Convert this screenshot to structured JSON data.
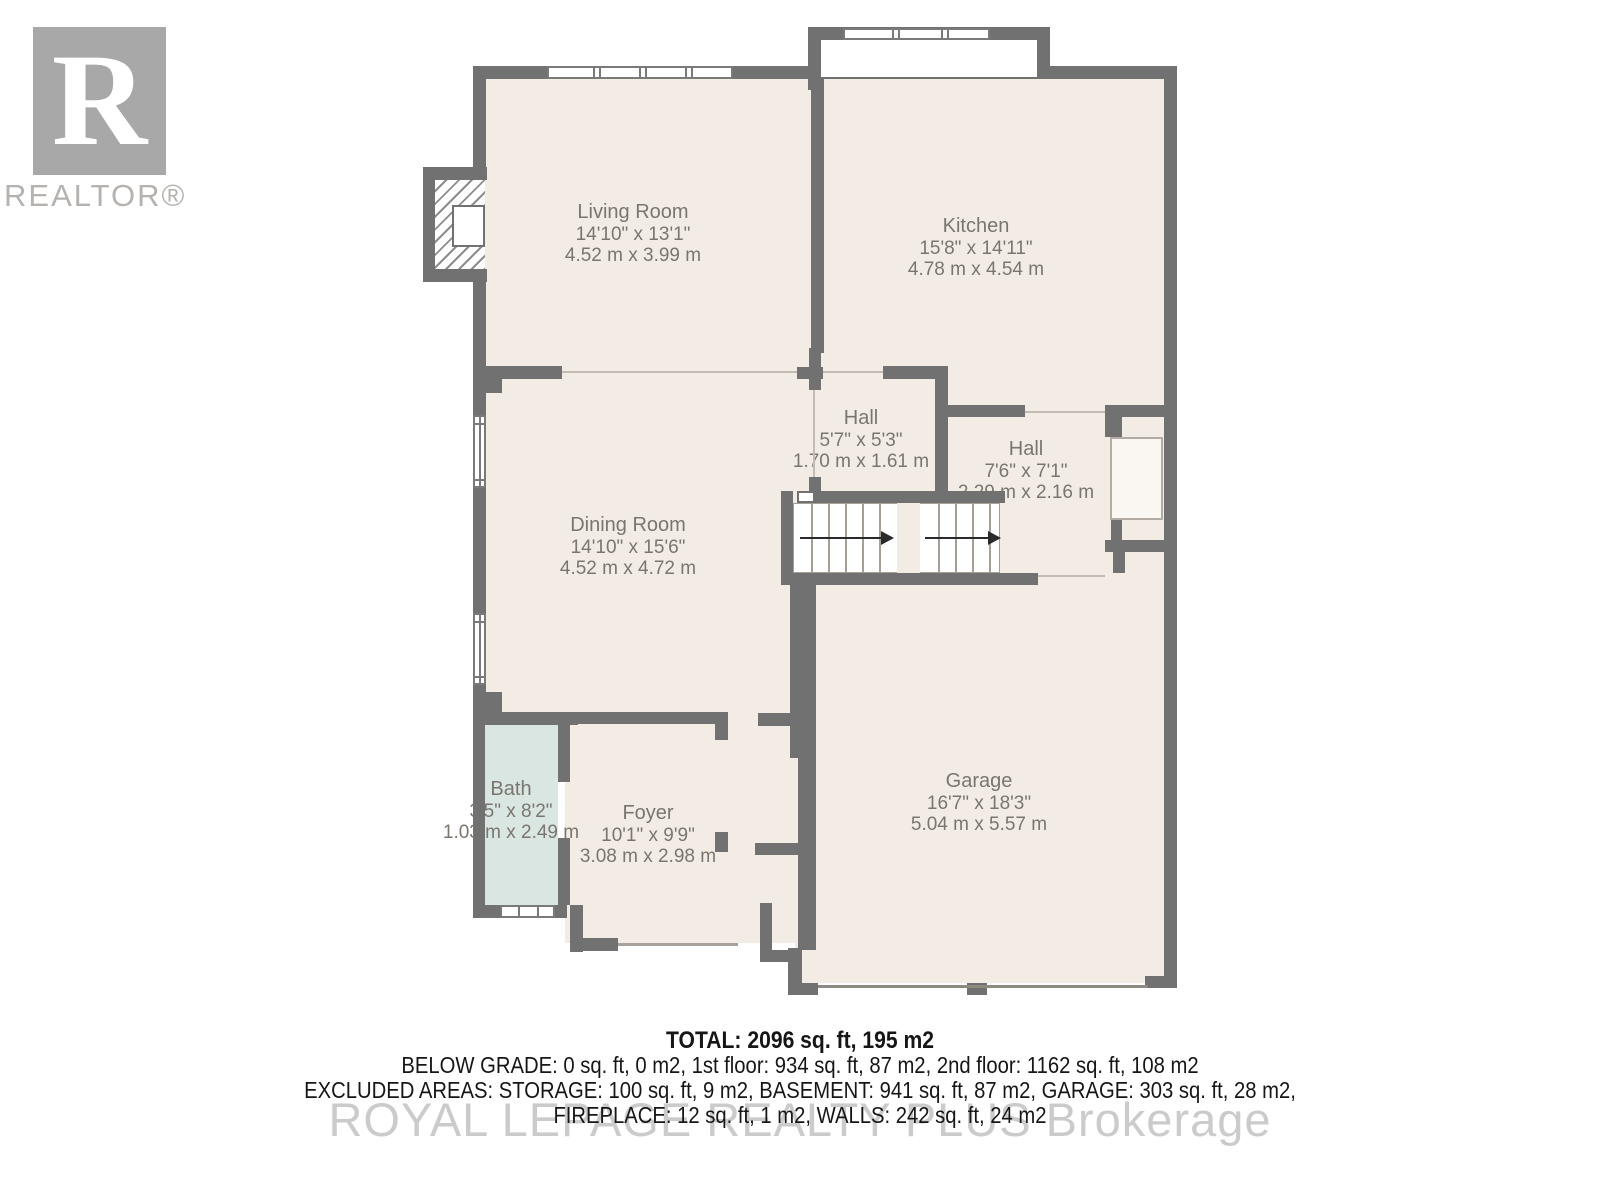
{
  "logo": {
    "letter": "R",
    "label": "REALTOR®"
  },
  "rooms": [
    {
      "id": "living-room",
      "name": "Living Room",
      "imperial": "14'10\" x 13'1\"",
      "metric": "4.52 m x 3.99 m"
    },
    {
      "id": "kitchen",
      "name": "Kitchen",
      "imperial": "15'8\" x 14'11\"",
      "metric": "4.78 m x 4.54 m"
    },
    {
      "id": "hall-1",
      "name": "Hall",
      "imperial": "5'7\" x 5'3\"",
      "metric": "1.70 m x 1.61 m"
    },
    {
      "id": "hall-2",
      "name": "Hall",
      "imperial": "7'6\" x 7'1\"",
      "metric": "2.29 m x 2.16 m"
    },
    {
      "id": "dining-room",
      "name": "Dining Room",
      "imperial": "14'10\" x 15'6\"",
      "metric": "4.52 m x 4.72 m"
    },
    {
      "id": "bath",
      "name": "Bath",
      "imperial": "3'5\" x 8'2\"",
      "metric": "1.03 m x 2.49 m"
    },
    {
      "id": "foyer",
      "name": "Foyer",
      "imperial": "10'1\" x 9'9\"",
      "metric": "3.08 m x 2.98 m"
    },
    {
      "id": "garage",
      "name": "Garage",
      "imperial": "16'7\" x 18'3\"",
      "metric": "5.04 m x 5.57 m"
    }
  ],
  "summary": {
    "total": "TOTAL: 2096 sq. ft, 195 m2",
    "line2": "BELOW GRADE: 0 sq. ft, 0 m2, 1st floor: 934 sq. ft, 87 m2, 2nd floor: 1162 sq. ft, 108 m2",
    "line3": "EXCLUDED AREAS: STORAGE: 100 sq. ft, 9 m2, BASEMENT: 941 sq. ft, 87 m2, GARAGE: 303 sq. ft, 28 m2,",
    "line4": "FIREPLACE: 12 sq. ft, 1 m2, WALLS: 242 sq. ft, 24 m2"
  },
  "watermark": "ROYAL LEPAGE REALTY PLUS Brokerage",
  "colors": {
    "wall": "#717171",
    "floor": "#f3ece5",
    "bath": "#d9e6e2",
    "label_text": "#7a766f",
    "logo_gray": "#a8a8a8"
  }
}
